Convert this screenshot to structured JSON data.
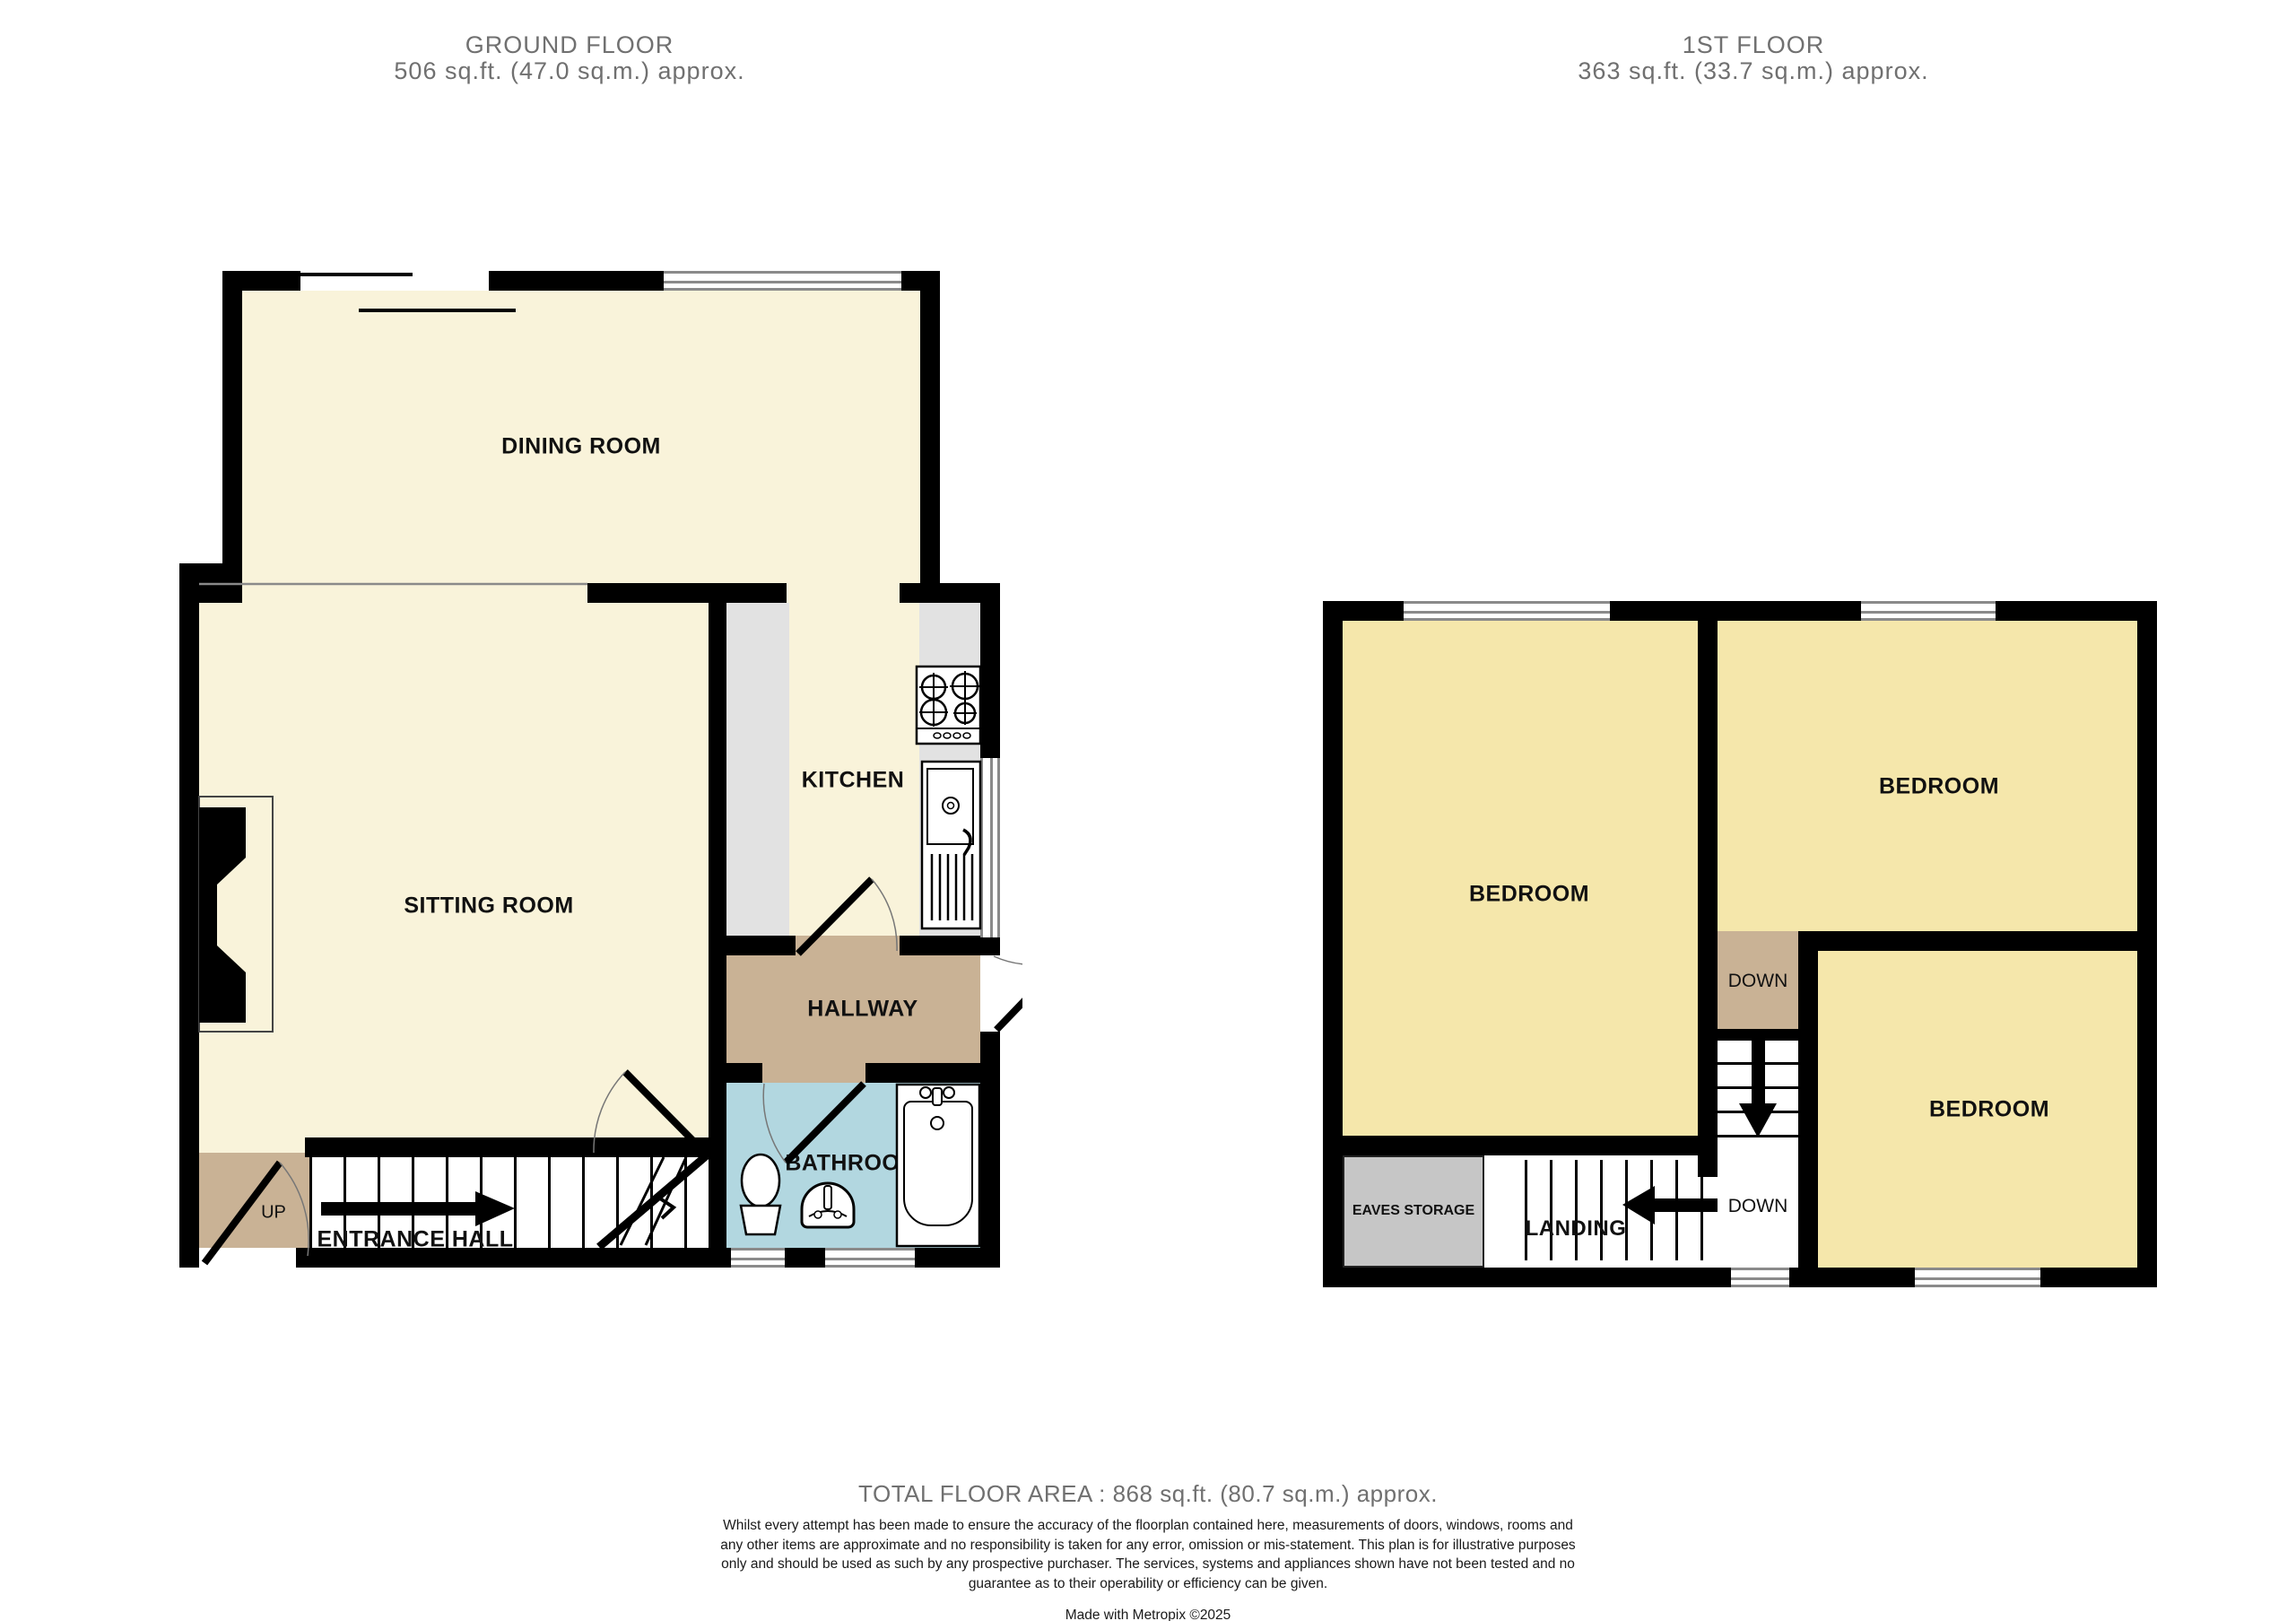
{
  "colors": {
    "walls": "#000000",
    "ground_room_fill": "#f9f3da",
    "first_room_fill": "#f5e7ab",
    "hall_fill": "#c9b295",
    "bathroom_fill": "#b2d7e0",
    "counter_fill": "#e2e2e2",
    "eaves_fill": "#c6c6c6",
    "title_text": "#707070",
    "label_text": "#111111"
  },
  "ground_floor": {
    "title": "GROUND FLOOR",
    "area": "506 sq.ft. (47.0 sq.m.) approx.",
    "rooms": {
      "dining": "DINING ROOM",
      "sitting": "SITTING ROOM",
      "kitchen": "KITCHEN",
      "hallway": "HALLWAY",
      "bathroom": "BATHROOM",
      "entrance_hall": "ENTRANCE HALL"
    },
    "stairs_label": "UP"
  },
  "first_floor": {
    "title": "1ST FLOOR",
    "area": "363 sq.ft. (33.7 sq.m.) approx.",
    "rooms": {
      "bedroom_left": "BEDROOM",
      "bedroom_top_right": "BEDROOM",
      "bedroom_bottom_right": "BEDROOM",
      "landing": "LANDING",
      "eaves_storage": "EAVES STORAGE"
    },
    "stairs_top_label": "DOWN",
    "stairs_bottom_label": "DOWN"
  },
  "footer": {
    "total_area": "TOTAL FLOOR AREA : 868 sq.ft. (80.7 sq.m.) approx.",
    "disclaimer": "Whilst every attempt has been made to ensure the accuracy of the floorplan contained here, measurements of doors, windows, rooms and any other items are approximate and no responsibility is taken for any error, omission or mis-statement. This plan is for illustrative purposes only and should be used as such by any prospective purchaser. The services, systems and appliances shown have not been tested and no guarantee as to their operability or efficiency can be given.",
    "credit": "Made with Metropix ©2025"
  }
}
